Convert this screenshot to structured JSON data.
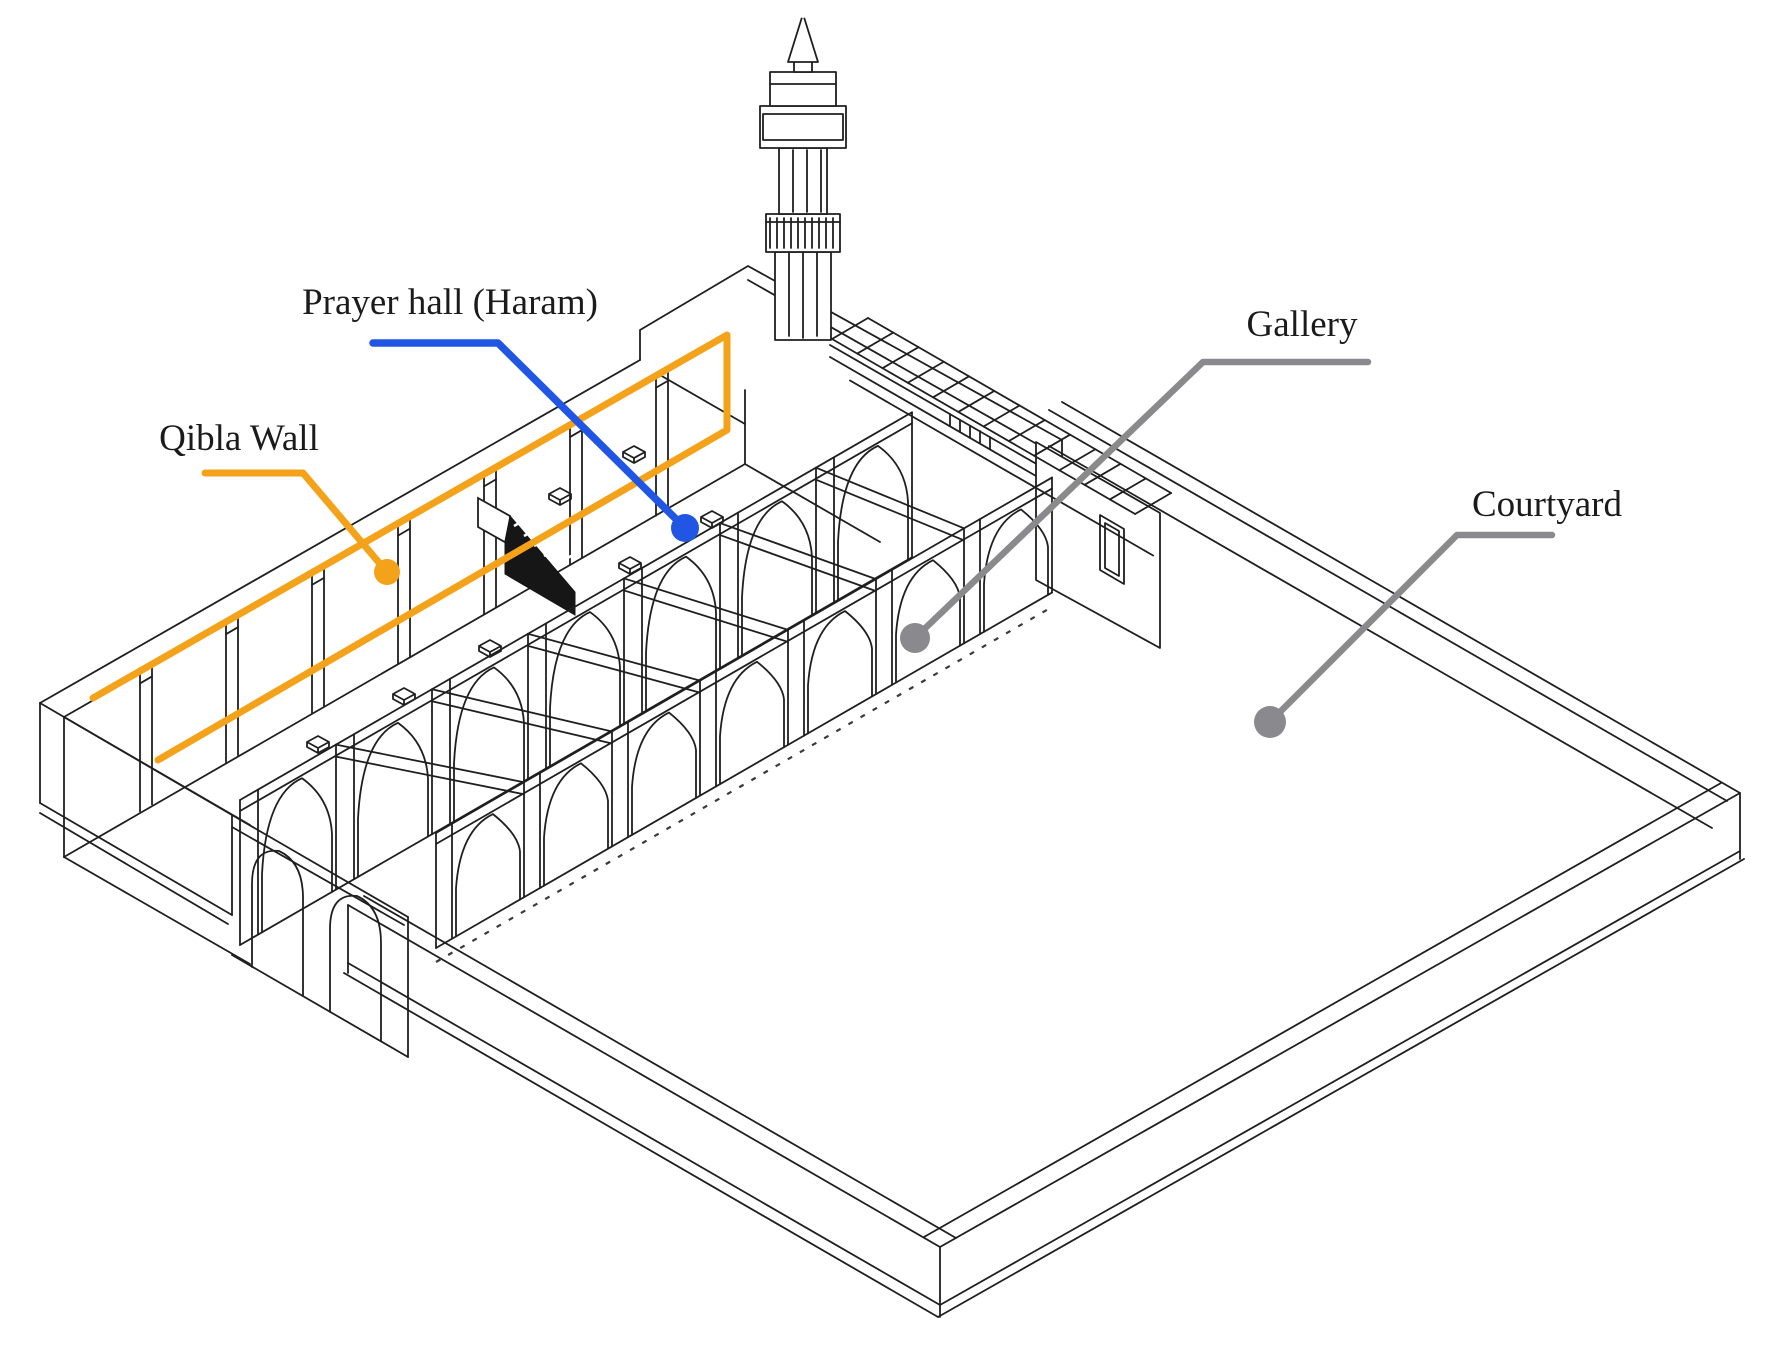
{
  "labels": {
    "prayer_hall": "Prayer hall (Haram)",
    "qibla_wall": "Qibla Wall",
    "gallery": "Gallery",
    "courtyard": "Courtyard"
  },
  "colors": {
    "background": "#ffffff",
    "drawing_line": "#1f1f1f",
    "label_text": "#1b1b1b",
    "qibla_highlight": "#F5A21B",
    "prayer_hall_marker": "#2155E4",
    "gallery_marker": "#8A8A8E",
    "courtyard_marker": "#8A8A8E"
  }
}
